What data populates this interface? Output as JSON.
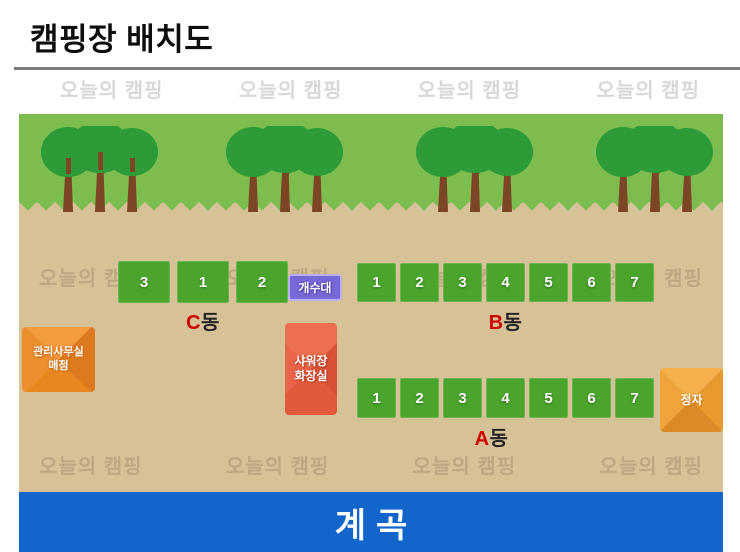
{
  "page": {
    "title": "캠핑장 배치도"
  },
  "watermark": {
    "text": "오늘의 캠핑"
  },
  "map": {
    "sites": {
      "c": {
        "label_prefix": "C",
        "label_suffix": "동",
        "numbers": [
          "3",
          "1",
          "2"
        ]
      },
      "b": {
        "label_prefix": "B",
        "label_suffix": "동",
        "numbers": [
          "1",
          "2",
          "3",
          "4",
          "5",
          "6",
          "7"
        ]
      },
      "a": {
        "label_prefix": "A",
        "label_suffix": "동",
        "numbers": [
          "1",
          "2",
          "3",
          "4",
          "5",
          "6",
          "7"
        ]
      }
    },
    "facilities": {
      "sink": {
        "label": "개수대"
      },
      "office": {
        "line1": "관리사무실",
        "line2": "매점"
      },
      "shower": {
        "line1": "샤워장",
        "line2": "화장실"
      },
      "pavilion": {
        "label": "정자"
      },
      "valley": {
        "label": "계곡"
      }
    },
    "colors": {
      "grass": "#7dbd4f",
      "tree_canopy": "#2d9b37",
      "tree_trunk": "#7c4526",
      "ground": "#d7c298",
      "site_green": "#4ba42b",
      "sink_purple": "#7668d6",
      "office_orange": "#e8822c",
      "shower_red": "#df5b3c",
      "pavilion_amber": "#efa13c",
      "valley_blue": "#1266cb",
      "label_red": "#d10000",
      "divider_gray": "#7b7b7b",
      "watermark_gray": "#d8d8d8"
    }
  }
}
